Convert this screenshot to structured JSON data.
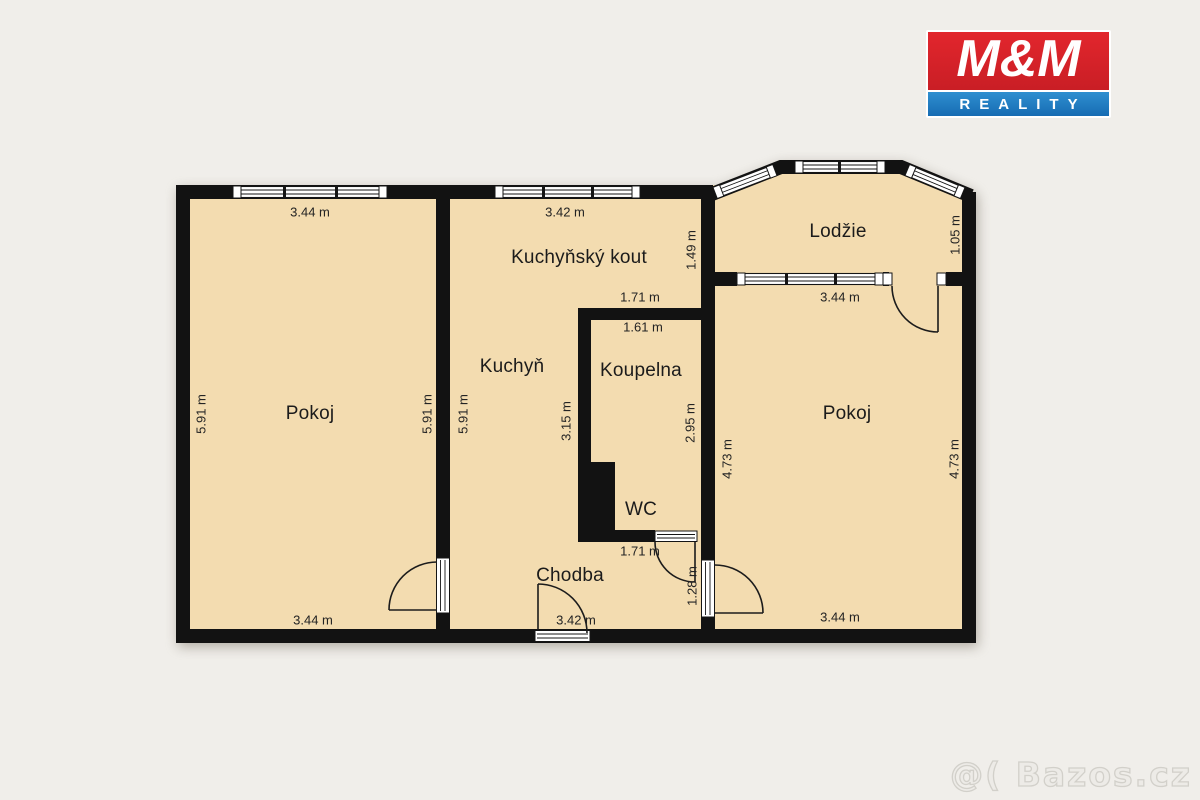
{
  "page": {
    "background": "#f0eeea"
  },
  "logo": {
    "title": "M&M",
    "subtitle": "REALITY",
    "red": "#d8232b",
    "blue": "#1b7fc3"
  },
  "watermark": {
    "text": "@( Bazos.cz"
  },
  "floorplan": {
    "wall_color": "#121212",
    "floor_color": "#f3dcb0",
    "rooms": [
      {
        "id": "pokoj-left",
        "label": "Pokoj"
      },
      {
        "id": "kuchyn",
        "label": "Kuchyň"
      },
      {
        "id": "kuchynsky-kout",
        "label": "Kuchyňský kout"
      },
      {
        "id": "koupelna",
        "label": "Koupelna"
      },
      {
        "id": "wc",
        "label": "WC"
      },
      {
        "id": "chodba",
        "label": "Chodba"
      },
      {
        "id": "lodzie",
        "label": "Lodžie"
      },
      {
        "id": "pokoj-right",
        "label": "Pokoj"
      }
    ],
    "dimensions": [
      {
        "id": "pokoj-left-top",
        "label": "3.44 m"
      },
      {
        "id": "pokoj-left-left",
        "label": "5.91 m"
      },
      {
        "id": "pokoj-left-right",
        "label": "5.91 m"
      },
      {
        "id": "pokoj-left-bottom",
        "label": "3.44 m"
      },
      {
        "id": "kuchyn-top",
        "label": "3.42 m"
      },
      {
        "id": "kuchyn-left",
        "label": "5.91 m"
      },
      {
        "id": "kuchynsky-kout-right",
        "label": "1.49 m"
      },
      {
        "id": "koupelna-above",
        "label": "1.71 m"
      },
      {
        "id": "koupelna-top",
        "label": "1.61 m"
      },
      {
        "id": "kuchyn-koupelna-side",
        "label": "3.15 m"
      },
      {
        "id": "koupelna-right",
        "label": "2.95 m"
      },
      {
        "id": "wc-below",
        "label": "1.71 m"
      },
      {
        "id": "chodba-door-side",
        "label": "1.28 m"
      },
      {
        "id": "chodba-bottom",
        "label": "3.42 m"
      },
      {
        "id": "lodzie-right",
        "label": "1.05 m"
      },
      {
        "id": "lodzie-below",
        "label": "3.44 m"
      },
      {
        "id": "pokoj-right-left",
        "label": "4.73 m"
      },
      {
        "id": "pokoj-right-right",
        "label": "4.73 m"
      },
      {
        "id": "pokoj-right-bottom",
        "label": "3.44 m"
      }
    ]
  }
}
